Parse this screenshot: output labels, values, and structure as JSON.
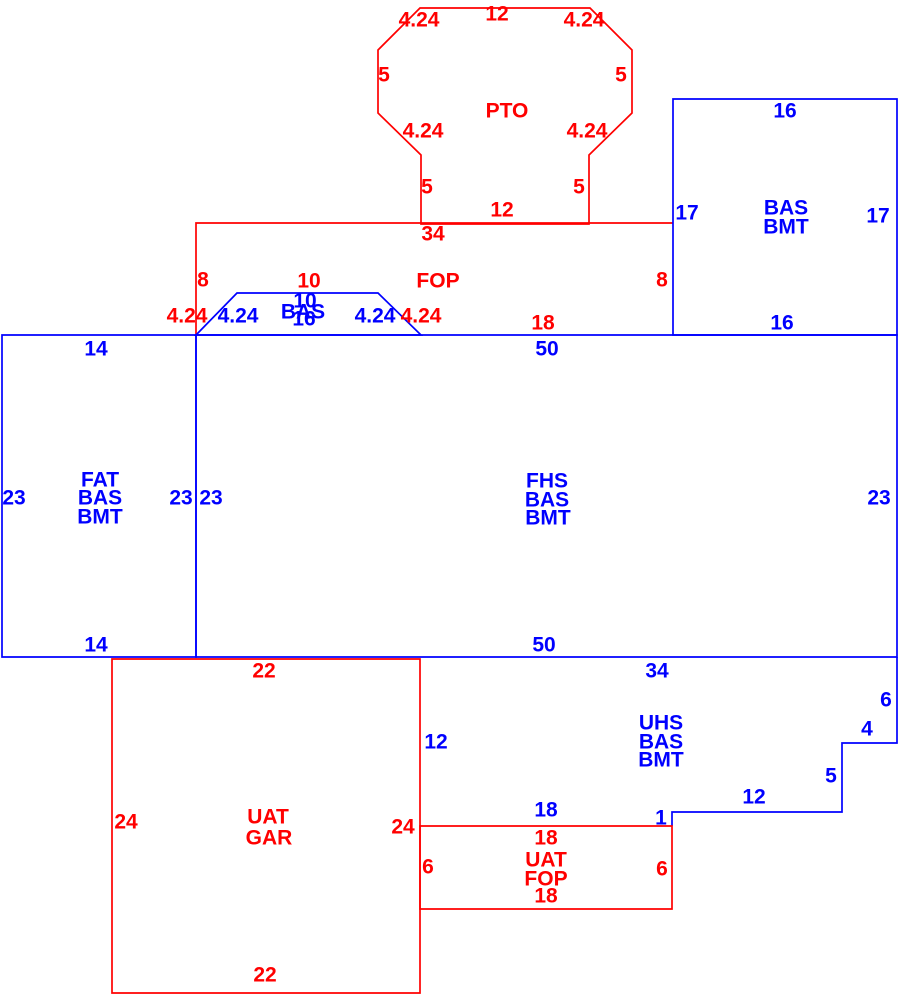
{
  "palette": {
    "red": "#ff0000",
    "blue": "#0000ff"
  },
  "sketch": {
    "width": 912,
    "height": 1005,
    "areas": [
      {
        "name": "pto",
        "color": "red",
        "closed": true,
        "points": "421,224 421,155 378,113 378,50 420,8 590,8 632,50 632,113 589,155 589,224"
      },
      {
        "name": "fop",
        "color": "red",
        "closed": false,
        "points": "196,335 196,223 673,223"
      },
      {
        "name": "bas-bmt",
        "color": "blue",
        "closed": true,
        "points": "673,99 897,99 897,335 673,335"
      },
      {
        "name": "bas-bump",
        "color": "blue",
        "closed": true,
        "points": "196,335 237,293 378,293 421,335"
      },
      {
        "name": "fat",
        "color": "blue",
        "closed": true,
        "points": "2,335 196,335 196,657 2,657"
      },
      {
        "name": "fhs",
        "color": "blue",
        "closed": true,
        "points": "196,335 897,335 897,657 196,657"
      },
      {
        "name": "uhs",
        "color": "blue",
        "closed": false,
        "points": "897,657 897,743 842,743 842,812 672,812 672,826"
      },
      {
        "name": "uat-gar",
        "color": "red",
        "closed": true,
        "points": "112,659 420,659 420,993 112,993"
      },
      {
        "name": "uat-fop",
        "color": "red",
        "closed": true,
        "points": "420,826 672,826 672,909 420,909"
      }
    ],
    "labels": [
      {
        "name": "dim-pto-top",
        "text": "12",
        "x": 497,
        "y": 14,
        "color": "red"
      },
      {
        "name": "dim-pto-nw-diag",
        "text": "4.24",
        "x": 419,
        "y": 20,
        "color": "red"
      },
      {
        "name": "dim-pto-ne-diag",
        "text": "4.24",
        "x": 584,
        "y": 20,
        "color": "red"
      },
      {
        "name": "dim-pto-west",
        "text": "5",
        "x": 384,
        "y": 75,
        "color": "red"
      },
      {
        "name": "dim-pto-east",
        "text": "5",
        "x": 621,
        "y": 75,
        "color": "red"
      },
      {
        "name": "area-label-pto",
        "text": "PTO",
        "x": 507,
        "y": 111,
        "color": "red"
      },
      {
        "name": "dim-pto-sw-diag",
        "text": "4.24",
        "x": 423,
        "y": 131,
        "color": "red"
      },
      {
        "name": "dim-pto-se-diag",
        "text": "4.24",
        "x": 587,
        "y": 131,
        "color": "red"
      },
      {
        "name": "dim-pto-leg-west",
        "text": "5",
        "x": 427,
        "y": 187,
        "color": "red"
      },
      {
        "name": "dim-pto-leg-east",
        "text": "5",
        "x": 579,
        "y": 187,
        "color": "red"
      },
      {
        "name": "dim-pto-bottom",
        "text": "12",
        "x": 502,
        "y": 210,
        "color": "red"
      },
      {
        "name": "dim-fop-top",
        "text": "34",
        "x": 433,
        "y": 234,
        "color": "red"
      },
      {
        "name": "dim-fop-west",
        "text": "8",
        "x": 203,
        "y": 280,
        "color": "red"
      },
      {
        "name": "dim-fop-bump-top",
        "text": "10",
        "x": 309,
        "y": 281,
        "color": "red"
      },
      {
        "name": "area-label-fop",
        "text": "FOP",
        "x": 438,
        "y": 281,
        "color": "red"
      },
      {
        "name": "dim-fop-east",
        "text": "8",
        "x": 662,
        "y": 280,
        "color": "red"
      },
      {
        "name": "dim-fop-sw-diag",
        "text": "4.24",
        "x": 187,
        "y": 316,
        "color": "red"
      },
      {
        "name": "dim-fop-se-diag",
        "text": "4.24",
        "x": 421,
        "y": 316,
        "color": "red"
      },
      {
        "name": "dim-fop-bottom",
        "text": "18",
        "x": 543,
        "y": 323,
        "color": "red"
      },
      {
        "name": "dim-bas-bmt-top",
        "text": "16",
        "x": 785,
        "y": 111,
        "color": "blue"
      },
      {
        "name": "dim-bas-bmt-west",
        "text": "17",
        "x": 687,
        "y": 213,
        "color": "blue"
      },
      {
        "name": "area-label-bas-bmt-line1",
        "text": "BAS",
        "x": 786,
        "y": 208,
        "color": "blue"
      },
      {
        "name": "area-label-bas-bmt-line2",
        "text": "BMT",
        "x": 786,
        "y": 227,
        "color": "blue"
      },
      {
        "name": "dim-bas-bmt-east",
        "text": "17",
        "x": 878,
        "y": 216,
        "color": "blue"
      },
      {
        "name": "dim-bas-bmt-bottom",
        "text": "16",
        "x": 782,
        "y": 323,
        "color": "blue"
      },
      {
        "name": "dim-bas-bump-sw-diag",
        "text": "4.24",
        "x": 238,
        "y": 316,
        "color": "blue"
      },
      {
        "name": "dim-bas-bump-top",
        "text": "10",
        "x": 305,
        "y": 301,
        "color": "blue"
      },
      {
        "name": "area-label-bas-bump",
        "text": "BAS",
        "x": 303,
        "y": 312,
        "color": "blue"
      },
      {
        "name": "dim-bas-bump-bottom",
        "text": "16",
        "x": 304,
        "y": 319,
        "color": "blue"
      },
      {
        "name": "dim-bas-bump-se-diag",
        "text": "4.24",
        "x": 375,
        "y": 316,
        "color": "blue"
      },
      {
        "name": "dim-fat-top",
        "text": "14",
        "x": 96,
        "y": 349,
        "color": "blue"
      },
      {
        "name": "dim-fhs-top",
        "text": "50",
        "x": 547,
        "y": 349,
        "color": "blue"
      },
      {
        "name": "dim-fat-west",
        "text": "23",
        "x": 14,
        "y": 498,
        "color": "blue"
      },
      {
        "name": "area-label-fat-line1",
        "text": "FAT",
        "x": 100,
        "y": 480,
        "color": "blue"
      },
      {
        "name": "area-label-fat-line2",
        "text": "BAS",
        "x": 100,
        "y": 498,
        "color": "blue"
      },
      {
        "name": "area-label-fat-line3",
        "text": "BMT",
        "x": 100,
        "y": 517,
        "color": "blue"
      },
      {
        "name": "dim-fat-east",
        "text": "23",
        "x": 181,
        "y": 498,
        "color": "blue"
      },
      {
        "name": "dim-fhs-west",
        "text": "23",
        "x": 211,
        "y": 498,
        "color": "blue"
      },
      {
        "name": "area-label-fhs-line1",
        "text": "FHS",
        "x": 547,
        "y": 481,
        "color": "blue"
      },
      {
        "name": "area-label-fhs-line2",
        "text": "BAS",
        "x": 547,
        "y": 500,
        "color": "blue"
      },
      {
        "name": "area-label-fhs-line3",
        "text": "BMT",
        "x": 548,
        "y": 518,
        "color": "blue"
      },
      {
        "name": "dim-fhs-east",
        "text": "23",
        "x": 879,
        "y": 498,
        "color": "blue"
      },
      {
        "name": "dim-fat-bottom",
        "text": "14",
        "x": 96,
        "y": 645,
        "color": "blue"
      },
      {
        "name": "dim-fhs-bottom",
        "text": "50",
        "x": 544,
        "y": 645,
        "color": "blue"
      },
      {
        "name": "dim-uhs-top",
        "text": "34",
        "x": 657,
        "y": 671,
        "color": "blue"
      },
      {
        "name": "area-label-uhs-line1",
        "text": "UHS",
        "x": 661,
        "y": 723,
        "color": "blue"
      },
      {
        "name": "area-label-uhs-line2",
        "text": "BAS",
        "x": 661,
        "y": 742,
        "color": "blue"
      },
      {
        "name": "area-label-uhs-line3",
        "text": "BMT",
        "x": 661,
        "y": 760,
        "color": "blue"
      },
      {
        "name": "dim-uhs-east",
        "text": "6",
        "x": 886,
        "y": 700,
        "color": "blue"
      },
      {
        "name": "dim-uhs-step-in",
        "text": "4",
        "x": 867,
        "y": 729,
        "color": "blue"
      },
      {
        "name": "dim-uhs-step-down",
        "text": "5",
        "x": 831,
        "y": 776,
        "color": "blue"
      },
      {
        "name": "dim-uhs-step-left",
        "text": "12",
        "x": 754,
        "y": 797,
        "color": "blue"
      },
      {
        "name": "dim-uhs-step-notch",
        "text": "1",
        "x": 661,
        "y": 818,
        "color": "blue"
      },
      {
        "name": "dim-uhs-west",
        "text": "12",
        "x": 436,
        "y": 742,
        "color": "blue"
      },
      {
        "name": "dim-uhs-bottom",
        "text": "18",
        "x": 546,
        "y": 810,
        "color": "blue"
      },
      {
        "name": "dim-uat-gar-top",
        "text": "22",
        "x": 264,
        "y": 671,
        "color": "red"
      },
      {
        "name": "dim-uat-gar-west",
        "text": "24",
        "x": 126,
        "y": 822,
        "color": "red"
      },
      {
        "name": "area-label-uat-gar-line1",
        "text": "UAT",
        "x": 268,
        "y": 817,
        "color": "red"
      },
      {
        "name": "area-label-uat-gar-line2",
        "text": "GAR",
        "x": 269,
        "y": 838,
        "color": "red"
      },
      {
        "name": "dim-uat-gar-east",
        "text": "24",
        "x": 403,
        "y": 827,
        "color": "red"
      },
      {
        "name": "dim-uat-fop-west",
        "text": "6",
        "x": 428,
        "y": 867,
        "color": "red"
      },
      {
        "name": "dim-uat-fop-top",
        "text": "18",
        "x": 546,
        "y": 838,
        "color": "red"
      },
      {
        "name": "area-label-uat-fop-line1",
        "text": "UAT",
        "x": 546,
        "y": 860,
        "color": "red"
      },
      {
        "name": "area-label-uat-fop-line2",
        "text": "FOP",
        "x": 546,
        "y": 879,
        "color": "red"
      },
      {
        "name": "dim-uat-fop-bottom",
        "text": "18",
        "x": 546,
        "y": 896,
        "color": "red"
      },
      {
        "name": "dim-uat-fop-east",
        "text": "6",
        "x": 662,
        "y": 869,
        "color": "red"
      },
      {
        "name": "dim-uat-gar-bottom",
        "text": "22",
        "x": 265,
        "y": 975,
        "color": "red"
      }
    ]
  }
}
